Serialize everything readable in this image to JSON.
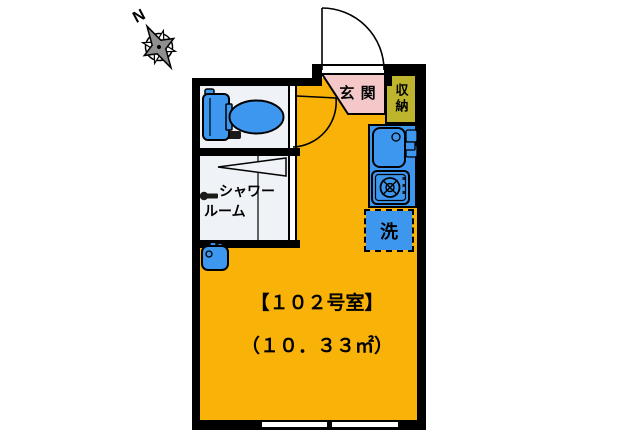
{
  "plan": {
    "compass_label": "N",
    "entrance_label": "玄 関",
    "storage_label": "収納",
    "shower_line1": "シャワー",
    "shower_line2": "ルーム",
    "washer_label": "洗",
    "room_title": "【１０２号室】",
    "room_area": "（１０．３３㎡）"
  },
  "colors": {
    "floor": "#F9B208",
    "entrance": "#F4C7C9",
    "storage": "#BFB52C",
    "fixture": "#3E97EE",
    "sanitary": "#EFF2F6",
    "wall": "#000000"
  }
}
